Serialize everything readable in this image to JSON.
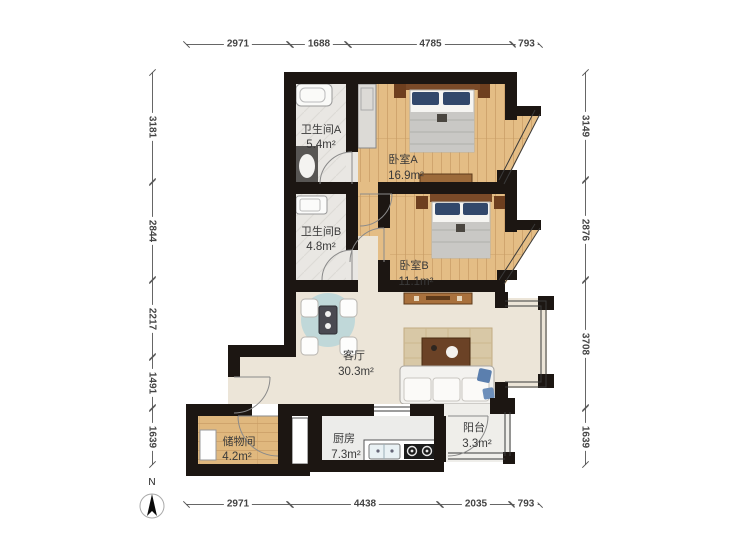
{
  "compass": {
    "label": "N"
  },
  "dimensions": {
    "top": [
      "2971",
      "1688",
      "4785",
      "793"
    ],
    "bottom": [
      "2971",
      "4438",
      "2035",
      "793"
    ],
    "left": [
      "3181",
      "2844",
      "2217",
      "1491",
      "1639"
    ],
    "right": [
      "3149",
      "2876",
      "3708",
      "1639"
    ]
  },
  "rooms": {
    "bathroomA": {
      "name": "卫生间A",
      "area": "5.4m²"
    },
    "bedroomA": {
      "name": "卧室A",
      "area": "16.9m²"
    },
    "bathroomB": {
      "name": "卫生间B",
      "area": "4.8m²"
    },
    "bedroomB": {
      "name": "卧室B",
      "area": "11.1m²"
    },
    "living": {
      "name": "客厅",
      "area": "30.3m²"
    },
    "storage": {
      "name": "储物间",
      "area": "4.2m²"
    },
    "kitchen": {
      "name": "厨房",
      "area": "7.3m²"
    },
    "balcony": {
      "name": "阳台",
      "area": "3.3m²"
    }
  },
  "colors": {
    "wall": "#1c1612",
    "wood_floor": "#e4bd85",
    "tile_floor": "#e9e7e3",
    "living_floor": "#ece5d8",
    "kitchen_floor": "#ececea",
    "balcony_floor": "#efeeea",
    "dining_table_accent": "#bcd7d9",
    "pillow_navy": "#32486b",
    "furniture_brown": "#9c6a3a",
    "dim_line": "#555555"
  }
}
